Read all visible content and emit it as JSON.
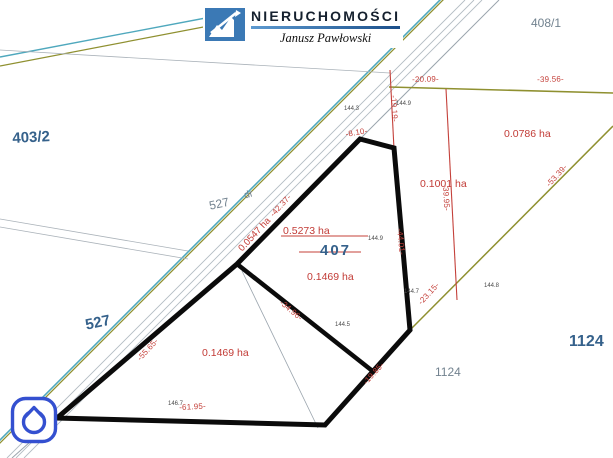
{
  "logo": {
    "brand": "NIERUCHOMOŚCI",
    "owner": "Janusz Pawłowski",
    "mark_icon": "chart-growth-arrow-icon",
    "mark_color": "#3b79b5"
  },
  "watermark_icon": "house-in-rounded-square-icon",
  "parcels": {
    "p403": "403/2",
    "p527_bold": "527",
    "p527_small": "527",
    "road": "dr",
    "p408": "408/1",
    "p407": "407",
    "p1124_bold": "1124",
    "p1124_small": "1124"
  },
  "areas": {
    "a_5273": "0.5273 ha",
    "a_1469_center": "0.1469 ha",
    "a_1469_left": "0.1469 ha",
    "a_1001": "0.1001 ha",
    "a_0786": "0.0786 ha",
    "a_0547": "0.0547 ha"
  },
  "measurements": {
    "m_2009": "-20.09-",
    "m_3956": "-39.56-",
    "m_1919": "-19.19-",
    "m_810": "-8.10-",
    "m_4237": "-42.37-",
    "m_5565": "-55.65-",
    "m_6195": "-61.95-",
    "m_1985": "-19.85-",
    "m_3496": "-34.96-",
    "m_4401": "-44.01-",
    "m_2315": "-23.15-",
    "m_3995": "-39.95-",
    "m_5339": "-53.39-"
  },
  "points": {
    "e1": "144.9",
    "e2": "144.9",
    "e3": "144.3",
    "e4": "144.5",
    "e5": "144.7",
    "e6": "144.8",
    "e7": "146.7"
  },
  "colors": {
    "boundary_black": "#0b0b0b",
    "road_cyan": "#4fa8bd",
    "road_olive": "#8f9030",
    "measure_red": "#c4403a",
    "label_navy": "#35618b",
    "label_gray": "#72828f",
    "icon_blue": "#3450d0"
  }
}
